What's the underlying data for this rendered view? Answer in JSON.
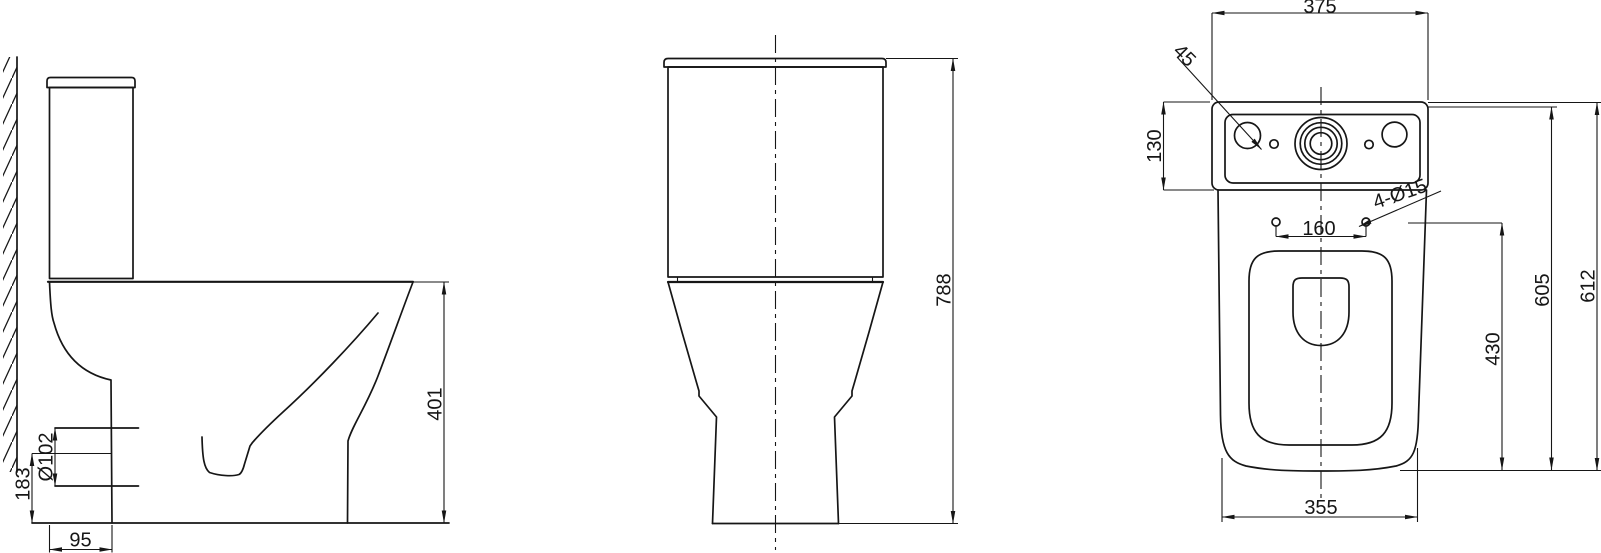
{
  "colors": {
    "line": "#161616",
    "background": "#ffffff"
  },
  "dimensions": {
    "side_view": {
      "outlet_center_height": "183",
      "outlet_diameter": "Ø102",
      "outlet_wall_distance": "95",
      "rim_height": "401"
    },
    "front_view": {
      "overall_height": "788"
    },
    "top_view": {
      "tank_width": "375",
      "flush_hole_diameter": "45",
      "tank_depth": "130",
      "fixing_hole_spacing": "160",
      "fixing_holes": "4-Ø15",
      "fixing_hole_depth": "430",
      "tank_front_depth": "605",
      "overall_depth": "612",
      "bowl_width": "355"
    }
  }
}
